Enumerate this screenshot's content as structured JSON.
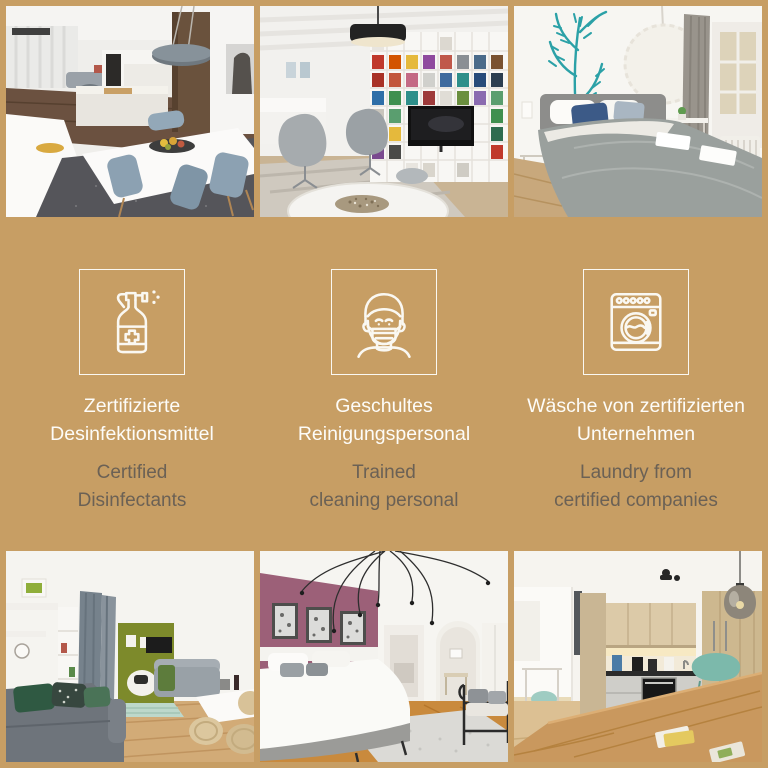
{
  "colors": {
    "background": "#c79e64",
    "title": "#fdfcf8",
    "subtitle": "#6b6155",
    "icon_stroke": "#faf8f2"
  },
  "band": {
    "features": [
      {
        "id": "disinfectants",
        "icon": "spray-bottle-icon",
        "title_lines": [
          "Zertifizierte",
          "Desinfektionsmittel"
        ],
        "subtitle_lines": [
          "Certified",
          "Disinfectants"
        ]
      },
      {
        "id": "cleaning-staff",
        "icon": "face-mask-icon",
        "title_lines": [
          "Geschultes",
          "Reinigungspersonal"
        ],
        "subtitle_lines": [
          "Trained",
          "cleaning personal"
        ]
      },
      {
        "id": "laundry",
        "icon": "washing-machine-icon",
        "title_lines": [
          "Wäsche von zertifizierten",
          "Unternehmen"
        ],
        "subtitle_lines": [
          "Laundry from",
          "certified companies"
        ]
      }
    ]
  },
  "photos": {
    "top": [
      {
        "name": "kitchen-dining-photo",
        "description": "Open kitchen with white dining table, blue chairs and fruit bowl"
      },
      {
        "name": "library-lounge-photo",
        "description": "Lounge with colorful floor-to-ceiling bookshelf, TV and grey armchairs"
      },
      {
        "name": "bedroom-plant-decal-photo",
        "description": "Bedroom with teal plant wall decal, grey bed and paper pendant lamp"
      }
    ],
    "bottom": [
      {
        "name": "living-room-green-photo",
        "description": "Living room with grey sofas, green accent wall and dining set"
      },
      {
        "name": "bedroom-purple-photo",
        "description": "Bedroom with berry accent wall, wire chandelier and white bed"
      },
      {
        "name": "kitchen-wood-photo",
        "description": "Kitchen with wooden cabinets, built-in oven and wooden dining table"
      }
    ]
  }
}
